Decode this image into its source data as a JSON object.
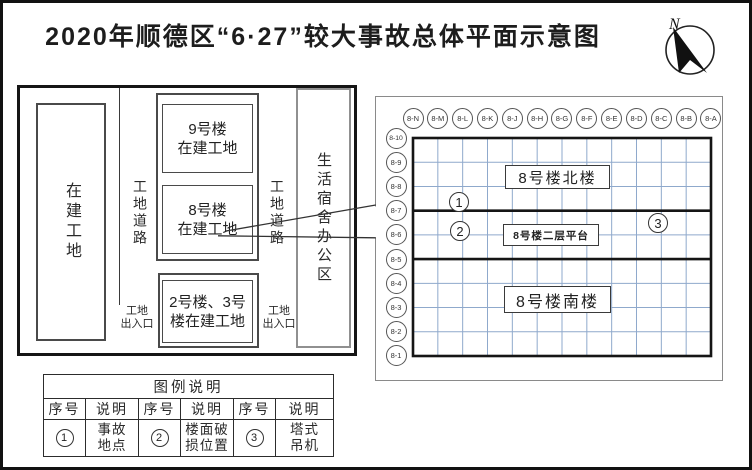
{
  "title": "2020年顺德区“6·27”较大事故总体平面示意图",
  "compass": {
    "north_label": "N"
  },
  "site_plan": {
    "left_site": "在建工地",
    "left_road": "工地道路",
    "right_road": "工地道路",
    "building_9": {
      "line1": "9号楼",
      "line2": "在建工地"
    },
    "building_8": {
      "line1": "8号楼",
      "line2": "在建工地"
    },
    "building_2_3": {
      "line1": "2号楼、3号",
      "line2": "楼在建工地"
    },
    "left_gate": {
      "line1": "工地",
      "line2": "出入口"
    },
    "right_gate": {
      "line1": "工地",
      "line2": "出入口"
    },
    "living_office_area": "生活宿舍办公区"
  },
  "detail_plan": {
    "column_labels": [
      "8-N",
      "8-M",
      "8-L",
      "8-K",
      "8-J",
      "8-H",
      "8-G",
      "8-F",
      "8-E",
      "8-D",
      "8-C",
      "8-B",
      "8-A"
    ],
    "row_labels": [
      "8-10",
      "8-9",
      "8-8",
      "8-7",
      "8-6",
      "8-5",
      "8-4",
      "8-3",
      "8-2",
      "8-1"
    ],
    "north_building_label": "8号楼北楼",
    "platform_label": "8号楼二层平台",
    "south_building_label": "8号楼南楼",
    "markers": [
      {
        "num": "1"
      },
      {
        "num": "2"
      },
      {
        "num": "3"
      }
    ]
  },
  "legend": {
    "title": "图例说明",
    "headers": [
      "序号",
      "说明",
      "序号",
      "说明",
      "序号",
      "说明"
    ],
    "entries": [
      {
        "num": "1",
        "line1": "事故",
        "line2": "地点"
      },
      {
        "num": "2",
        "line1": "楼面破",
        "line2": "损位置"
      },
      {
        "num": "3",
        "line1": "塔式",
        "line2": "吊机"
      }
    ]
  },
  "colors": {
    "grid_line": "#8fa9cc",
    "heavy_line": "#151515",
    "panel_gray": "#8a8a8a"
  }
}
